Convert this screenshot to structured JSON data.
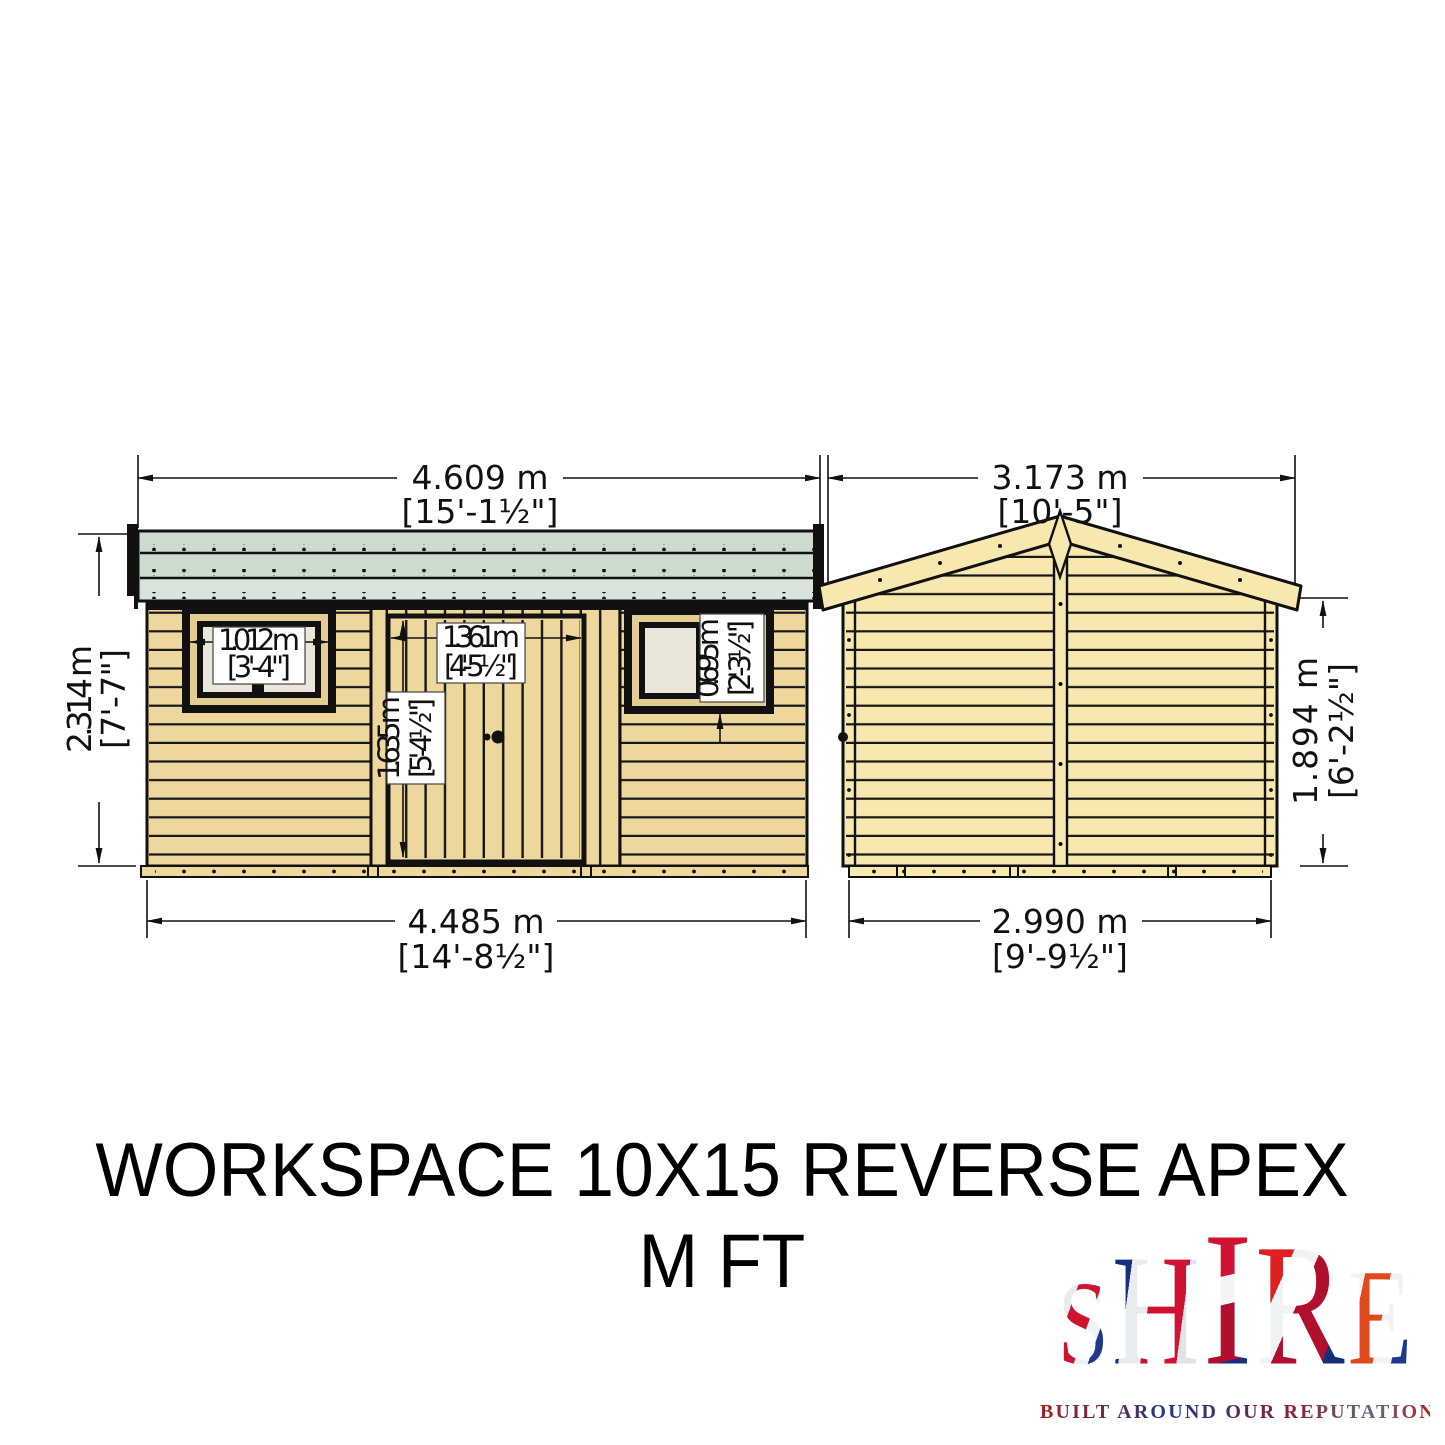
{
  "title": {
    "line1": "WORKSPACE 10X15 REVERSE APEX",
    "line2": "M FT"
  },
  "dimensions": {
    "front": {
      "overall_width": {
        "metric": "4.609 m",
        "imperial": "[15'-1½\"]"
      },
      "height": {
        "metric": "2.314 m",
        "imperial": "[7'-7\"]"
      },
      "base_width": {
        "metric": "4.485 m",
        "imperial": "[14'-8½\"]"
      },
      "window_width": {
        "metric": "1.012 m",
        "imperial": "[3'-4\"]"
      },
      "door_width": {
        "metric": "1.361 m",
        "imperial": "[4'-5½\"]"
      },
      "door_height": {
        "metric": "1.635 m",
        "imperial": "[5'-4½\"]"
      },
      "window_height": {
        "metric": "0.695 m",
        "imperial": "[2'-3½\"]"
      }
    },
    "side": {
      "overall_width": {
        "metric": "3.173 m",
        "imperial": "[10'-5\"]"
      },
      "height": {
        "metric": "1.894 m",
        "imperial": "[6'-2½\"]"
      },
      "base_width": {
        "metric": "2.990 m",
        "imperial": "[9'-9½\"]"
      }
    }
  },
  "logo": {
    "name": "SHIRE",
    "letters": [
      "S",
      "H",
      "I",
      "R",
      "E"
    ],
    "tagline": "BUILT AROUND OUR REPUTATION"
  },
  "colors": {
    "roof_felt": "#ccdbce",
    "roof_fascia": "#d8e4da",
    "timber_front": "#edd79c",
    "timber_side": "#f6e8ae",
    "window_frame": "#e3cd91",
    "window_pane": "#eae6da",
    "outline": "#111111"
  }
}
